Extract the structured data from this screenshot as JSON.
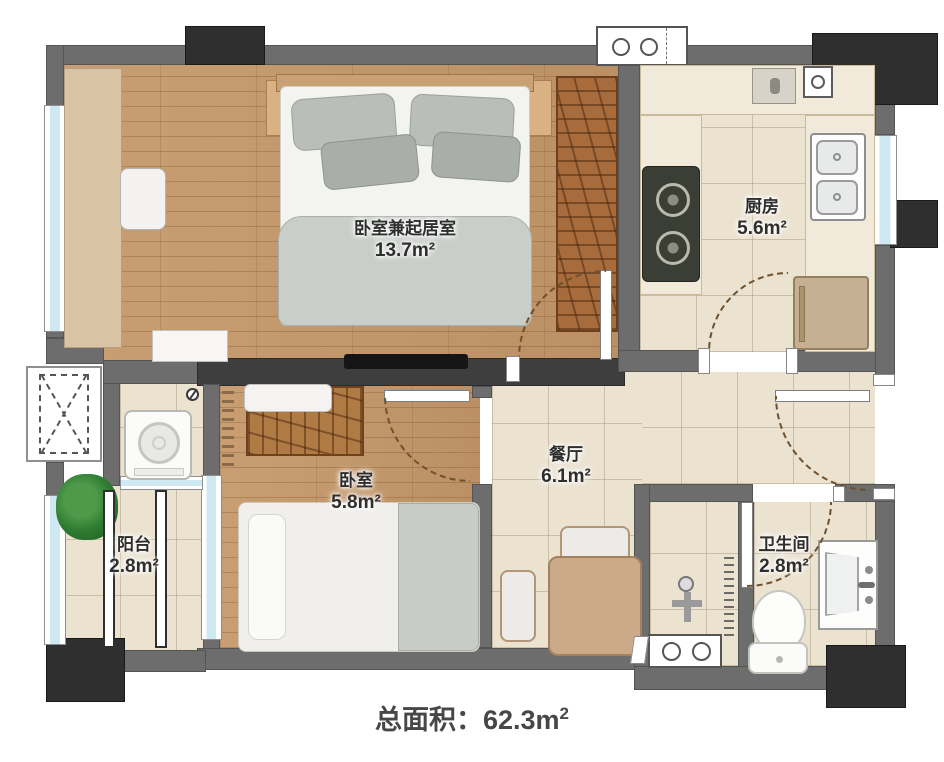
{
  "rooms": [
    {
      "id": "living-bedroom",
      "name": "卧室兼起居室",
      "area": "13.7m²"
    },
    {
      "id": "kitchen",
      "name": "厨房",
      "area": "5.6m²"
    },
    {
      "id": "bedroom",
      "name": "卧室",
      "area": "5.8m²"
    },
    {
      "id": "dining",
      "name": "餐厅",
      "area": "6.1m²"
    },
    {
      "id": "balcony",
      "name": "阳台",
      "area": "2.8m²"
    },
    {
      "id": "bathroom",
      "name": "卫生间",
      "area": "2.8m²"
    }
  ],
  "footer": {
    "label": "总面积：",
    "value": "62.3m",
    "sup": "2"
  },
  "colors": {
    "wall": "#6d6d6d",
    "wall_dark": "#3e3e3e",
    "pier": "#2f2f2f",
    "wood_floor": "#c1976b",
    "tile_floor": "#ebe2d0",
    "window_glass": "#cfe9f2",
    "counter": "#f1e9d9",
    "wardrobe_wood": "#a86c3c"
  }
}
